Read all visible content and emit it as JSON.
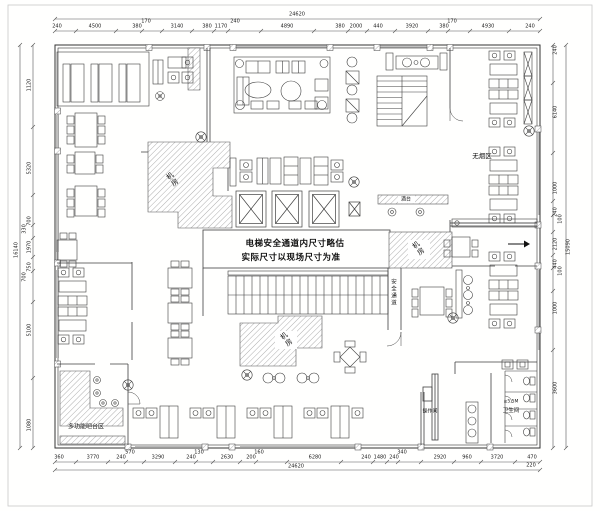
{
  "plan": {
    "note": {
      "line1": "电梯安全通道内尺寸略估",
      "line2": "实际尺寸以现场尺寸为准"
    },
    "rooms": {
      "machine_room_top_left": "机房",
      "machine_room_right": "机房",
      "machine_room_bottom": "机房",
      "no_smoking_area": "无烟区",
      "bar_counter": "酒台",
      "safety_passage": "安全通道",
      "multifunction_bar_area": "多功能吧台区",
      "operation_room": "操作间",
      "restroom": "卫生间",
      "restroom_note": "≥5.5M"
    }
  },
  "dimensions": {
    "overall_top": "24620",
    "overall_bottom": "24620",
    "overall_left": "16140",
    "overall_right": "15090",
    "bottom_offset": "220",
    "top_chain": [
      "240",
      "4500",
      "380",
      "170",
      "3140",
      "380",
      "1170",
      "240",
      "4890",
      "380",
      "2000",
      "440",
      "3920",
      "380",
      "170",
      "4930",
      "240"
    ],
    "bottom_chain": [
      "360",
      "3770",
      "240",
      "570",
      "3290",
      "240",
      "130",
      "2630",
      "200",
      "160",
      "6280",
      "240",
      "1480",
      "240",
      "340",
      "2920",
      "960",
      "3720",
      "470"
    ],
    "left_chain": [
      "1120",
      "5320",
      "700",
      "330",
      "1970",
      "750",
      "700",
      "5100",
      "1080"
    ],
    "right_chain": [
      "240",
      "6140",
      "1000",
      "240",
      "100",
      "2120",
      "440",
      "100",
      "1000",
      "3600"
    ]
  },
  "colors": {
    "line": "#3f3f3f",
    "hatch": "#9a9a9a",
    "background": "#ffffff",
    "text": "#111111"
  }
}
